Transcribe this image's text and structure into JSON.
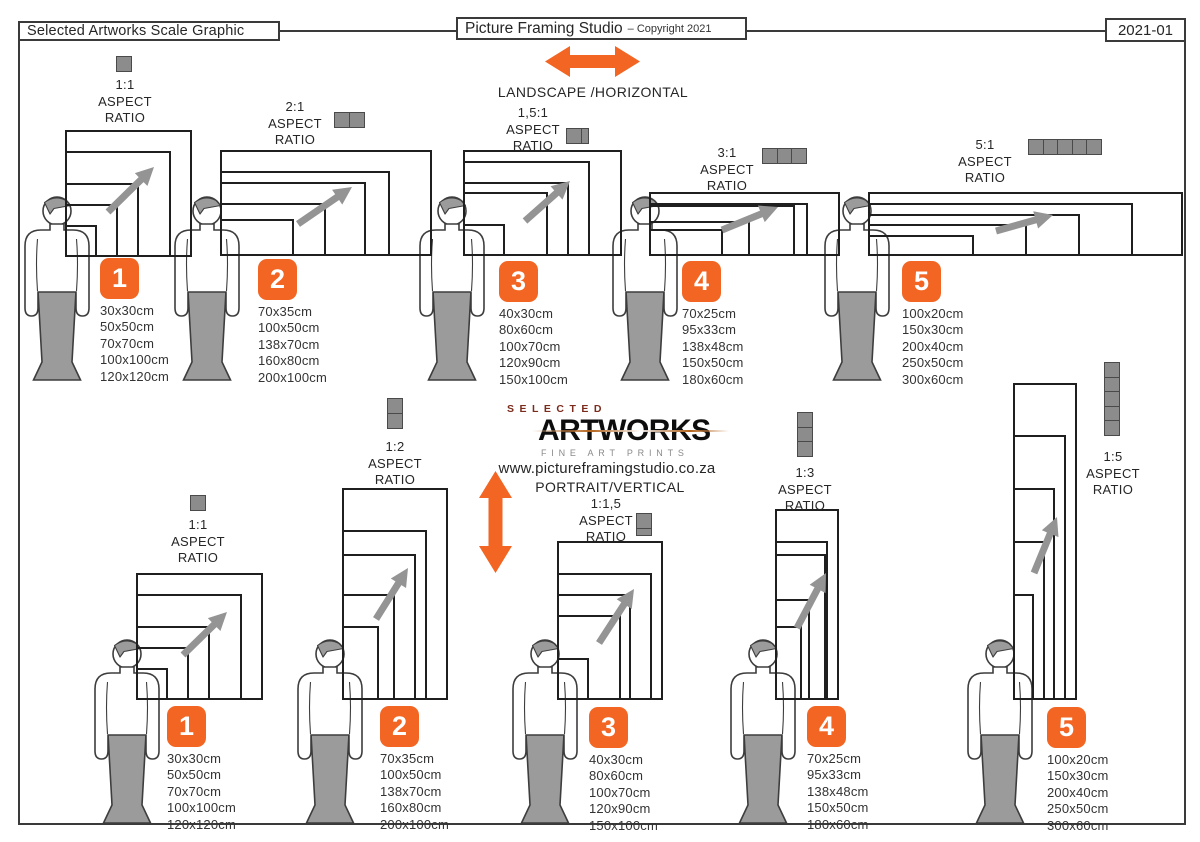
{
  "header": {
    "left_title": "Selected Artworks Scale Graphic",
    "studio_title": "Picture Framing Studio",
    "copyright": "– Copyright 2021",
    "doc_code": "2021-01"
  },
  "labels": {
    "aspect": "ASPECT",
    "ratio": "RATIO",
    "landscape": "LANDSCAPE /HORIZONTAL",
    "portrait": "PORTRAIT/VERTICAL",
    "website": "www.pictureframingstudio.co.za"
  },
  "logo": {
    "top": "SELECTED",
    "main": "ARTWORKS",
    "sub": "FINE ART PRINTS"
  },
  "colors": {
    "accent": "#F26522",
    "icon_gray": "#8C8C8C",
    "figure_gray": "#9b9b9b",
    "arrow_gray": "#949494"
  },
  "landscape_groups": [
    {
      "number": "1",
      "ratio": "1:1",
      "sizes": [
        "30x30cm",
        "50x50cm",
        "70x70cm",
        "100x100cm",
        "120x120cm"
      ]
    },
    {
      "number": "2",
      "ratio": "2:1",
      "sizes": [
        "70x35cm",
        "100x50cm",
        "138x70cm",
        "160x80cm",
        "200x100cm"
      ]
    },
    {
      "number": "3",
      "ratio": "1,5:1",
      "sizes": [
        "40x30cm",
        "80x60cm",
        "100x70cm",
        "120x90cm",
        "150x100cm"
      ]
    },
    {
      "number": "4",
      "ratio": "3:1",
      "sizes": [
        "70x25cm",
        "95x33cm",
        "138x48cm",
        "150x50cm",
        "180x60cm"
      ]
    },
    {
      "number": "5",
      "ratio": "5:1",
      "sizes": [
        "100x20cm",
        "150x30cm",
        "200x40cm",
        "250x50cm",
        "300x60cm"
      ]
    }
  ],
  "portrait_groups": [
    {
      "number": "1",
      "ratio": "1:1",
      "sizes": [
        "30x30cm",
        "50x50cm",
        "70x70cm",
        "100x100cm",
        "120x120cm"
      ]
    },
    {
      "number": "2",
      "ratio": "1:2",
      "sizes": [
        "70x35cm",
        "100x50cm",
        "138x70cm",
        "160x80cm",
        "200x100cm"
      ]
    },
    {
      "number": "3",
      "ratio": "1:1,5",
      "sizes": [
        "40x30cm",
        "80x60cm",
        "100x70cm",
        "120x90cm",
        "150x100cm"
      ]
    },
    {
      "number": "4",
      "ratio": "1:3",
      "sizes": [
        "70x25cm",
        "95x33cm",
        "138x48cm",
        "150x50cm",
        "180x60cm"
      ]
    },
    {
      "number": "5",
      "ratio": "1:5",
      "sizes": [
        "100x20cm",
        "150x30cm",
        "200x40cm",
        "250x50cm",
        "300x60cm"
      ]
    }
  ]
}
